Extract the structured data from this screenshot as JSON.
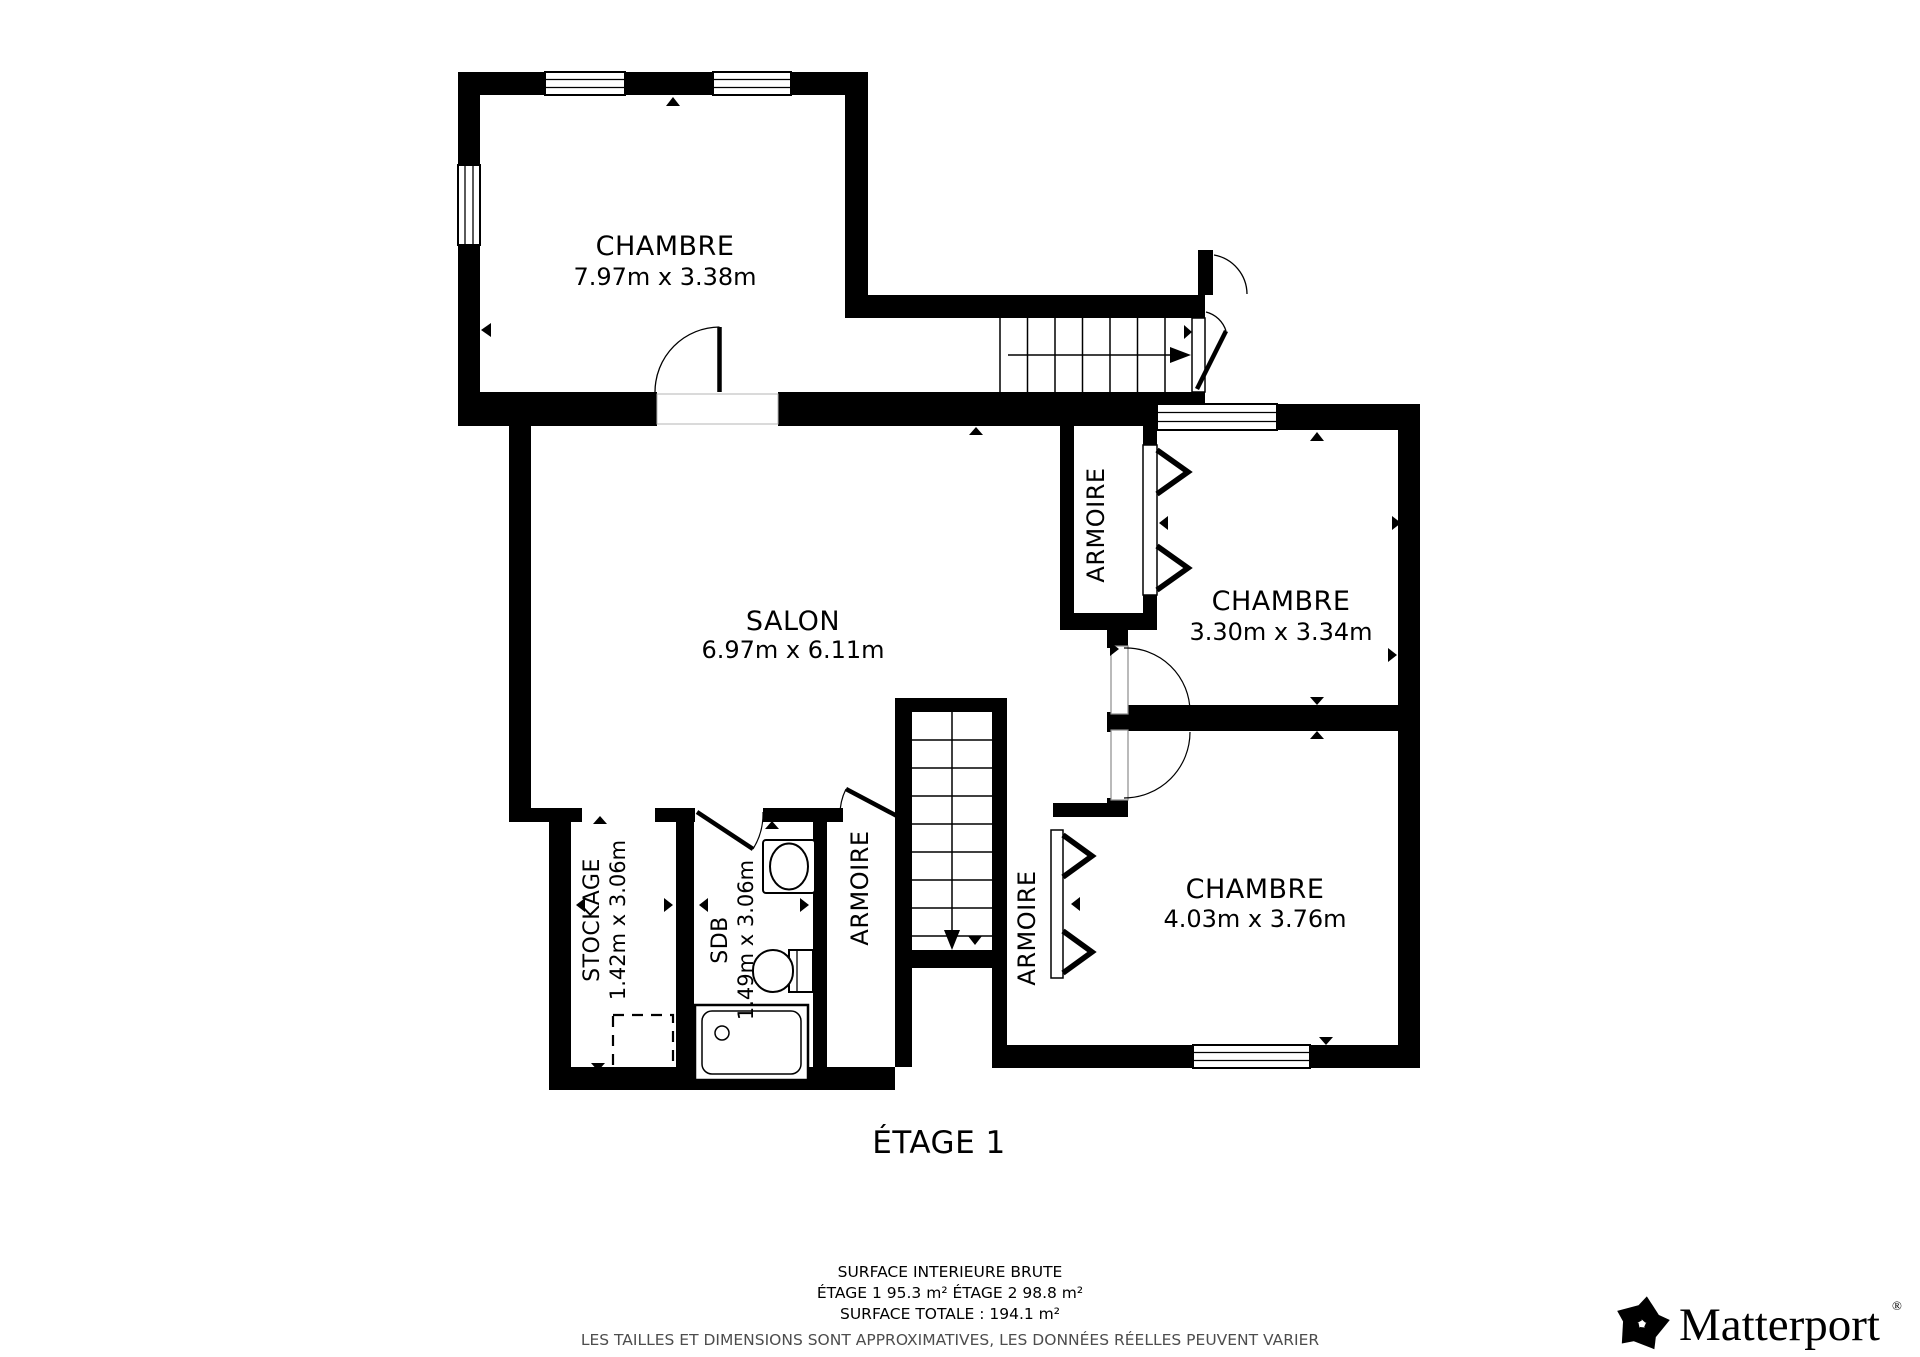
{
  "floor_title": "ÉTAGE 1",
  "rooms": {
    "chambre_top": {
      "name": "CHAMBRE",
      "dims": "7.97m x 3.38m"
    },
    "salon": {
      "name": "SALON",
      "dims": "6.97m x 6.11m"
    },
    "chambre_right": {
      "name": "CHAMBRE",
      "dims": "3.30m x 3.34m"
    },
    "chambre_bottom": {
      "name": "CHAMBRE",
      "dims": "4.03m x 3.76m"
    },
    "stockage": {
      "name": "STOCKAGE",
      "dims": "1.42m x 3.06m"
    },
    "sdb": {
      "name": "SDB",
      "dims": "1.49m x 3.06m"
    },
    "armoire_top": {
      "name": "ARMOIRE"
    },
    "armoire_left": {
      "name": "ARMOIRE"
    },
    "armoire_right": {
      "name": "ARMOIRE"
    }
  },
  "footer": {
    "surface_title": "SURFACE INTERIEURE BRUTE",
    "surface_floors": "ÉTAGE 1 95.3 m²   ÉTAGE 2 98.8 m²",
    "surface_total": "SURFACE TOTALE :  194.1 m²",
    "disclaimer": "LES TAILLES ET DIMENSIONS SONT APPROXIMATIVES, LES DONNÉES RÉELLES PEUVENT VARIER"
  },
  "branding": {
    "logo_text": "Matterport",
    "registered": "®"
  },
  "colors": {
    "walls": "#000000",
    "background": "#ffffff",
    "disclaimer_text": "#4d4d4d"
  }
}
